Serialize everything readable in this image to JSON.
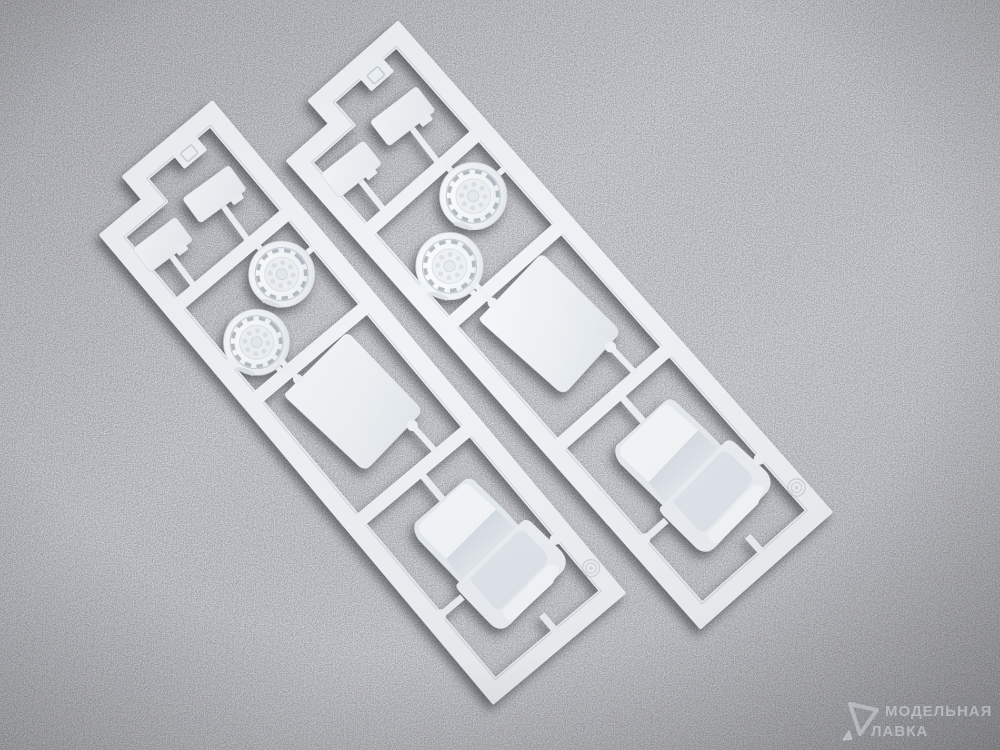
{
  "scene": {
    "subject": "Two identical white injection-molded plastic model kit sprues lying diagonally on dark gray speckled foam",
    "sprue_count": 2,
    "parts_per_sprue": [
      "small rectangular plate",
      "small rectangular plate",
      "drum wheel with dashed tread detail",
      "drum wheel with dashed tread detail",
      "flat floor panel",
      "bucket seat"
    ],
    "frame_details": [
      "embossed square tab on top rail",
      "molded concentric-ring emblem near bottom rail"
    ]
  },
  "sprues": [
    {
      "id": "sprue-left",
      "transform": "translate(82,212) rotate(-40)"
    },
    {
      "id": "sprue-right",
      "transform": "translate(268,138) rotate(-41.5) scale(1.02)"
    }
  ],
  "watermark": {
    "line1": "МОДЕЛЬНАЯ",
    "line2": "ЛАВКА",
    "logo": "rounded-triangle pick"
  },
  "colors": {
    "background": "#54555c",
    "plastic": "#f2f5f8",
    "plastic_shade": "#dde3e8",
    "plastic_highlight": "#ffffff",
    "tread_dash": "#aab3bb",
    "watermark_text": "rgba(216,222,231,0.55)"
  }
}
